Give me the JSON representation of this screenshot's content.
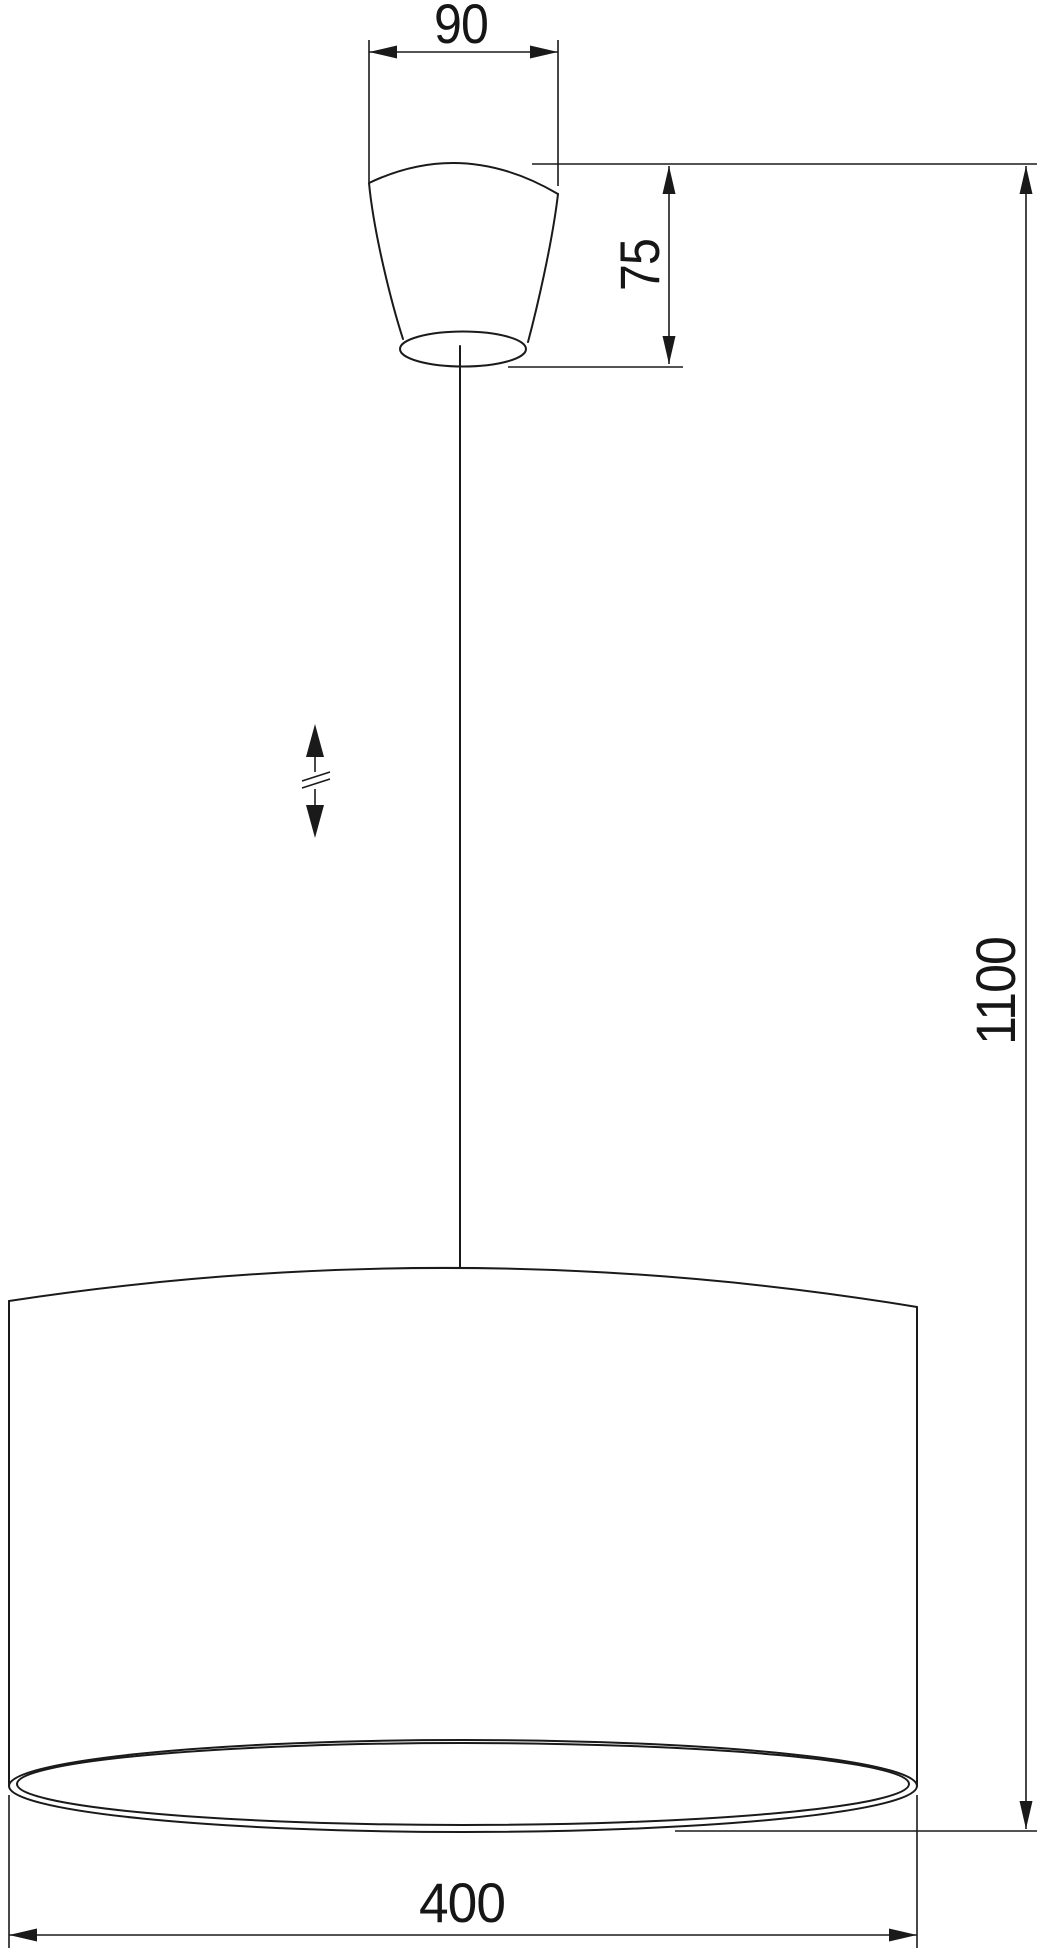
{
  "diagram": {
    "type": "technical-drawing",
    "subject": "pendant lamp dimensional drawing",
    "dimensions": {
      "canopy_width": "90",
      "canopy_height": "75",
      "overall_height": "1100",
      "shade_diameter": "400"
    },
    "icons": {
      "height_adjustment": "double-arrow-with-break"
    },
    "colors": {
      "line": "#1a1a1a",
      "background": "#ffffff"
    }
  }
}
